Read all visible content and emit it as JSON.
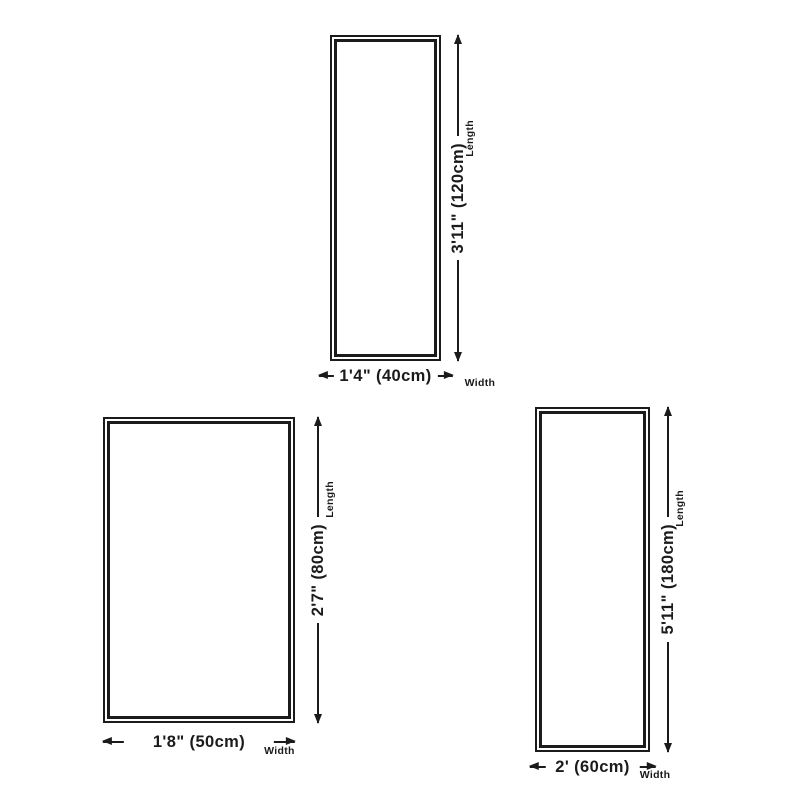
{
  "canvas": {
    "background": "#ffffff",
    "ink": "#1b1b1b"
  },
  "diagrams": [
    {
      "id": "rug-size-120x40",
      "length": {
        "label": "3'11\" (120cm)",
        "tag": "Length"
      },
      "width": {
        "label": "1'4\" (40cm)",
        "tag": "Width"
      }
    },
    {
      "id": "rug-size-80x50",
      "length": {
        "label": "2'7\" (80cm)",
        "tag": "Length"
      },
      "width": {
        "label": "1'8\" (50cm)",
        "tag": "Width"
      }
    },
    {
      "id": "rug-size-180x60",
      "length": {
        "label": "5'11\" (180cm)",
        "tag": "Length"
      },
      "width": {
        "label": "2' (60cm)",
        "tag": "Width"
      }
    }
  ]
}
